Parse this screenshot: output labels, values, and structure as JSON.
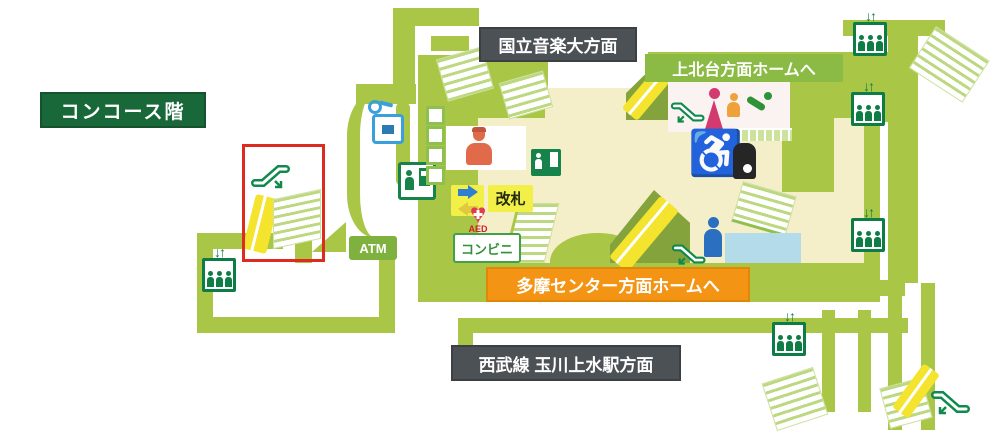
{
  "map": {
    "floor_label": "コンコース階",
    "destinations": {
      "music_college": "国立音楽大方面",
      "seibu_tamagawajosui": "西武線 玉川上水駅方面"
    },
    "platforms": {
      "kamikitadai": "上北台方面ホームへ",
      "tama_center": "多摩センター方面ホームへ"
    },
    "facilities": {
      "atm": "ATM",
      "ticket_gate": "改札",
      "convenience_store": "コンビニ",
      "aed": "AED"
    },
    "icons": {
      "elevator_arrows": "↓↑",
      "wheelchair": "♿"
    },
    "colors": {
      "path_green": "#a9c647",
      "banner_green": "#8bbb44",
      "floor_label_green": "#19683a",
      "destination_gray": "#4c5156",
      "platform_orange": "#f49414",
      "escalator_yellow": "#f4e42e",
      "hall_cream": "#f5efc9",
      "highlight_red": "#dd2b20",
      "icon_green": "#0e7d45"
    }
  }
}
